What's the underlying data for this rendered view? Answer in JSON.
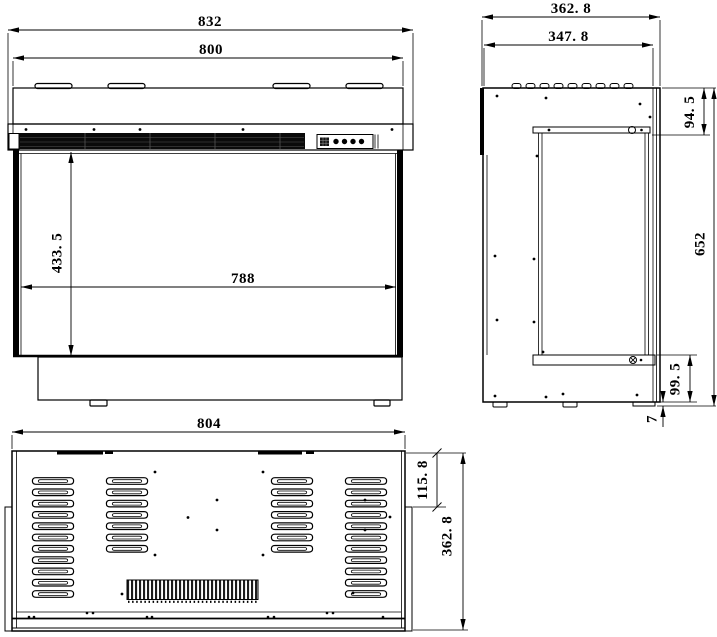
{
  "drawing": {
    "background": "#ffffff",
    "line_color": "#000000",
    "views": {
      "front": {
        "label": "front-view"
      },
      "side": {
        "label": "side-view"
      },
      "bottom": {
        "label": "bottom-view"
      }
    },
    "dimensions": {
      "front": {
        "overall_width": "832",
        "body_width": "800",
        "opening_height": "433. 5",
        "opening_width": "788"
      },
      "side": {
        "overall_depth": "362. 8",
        "body_depth": "347. 8",
        "top_section_height": "94. 5",
        "overall_height": "652",
        "bottom_section_height": "99. 5",
        "rear_base_offset": "7"
      },
      "bottom": {
        "width": "804",
        "side_step": "115. 8",
        "depth": "362. 8"
      }
    }
  }
}
